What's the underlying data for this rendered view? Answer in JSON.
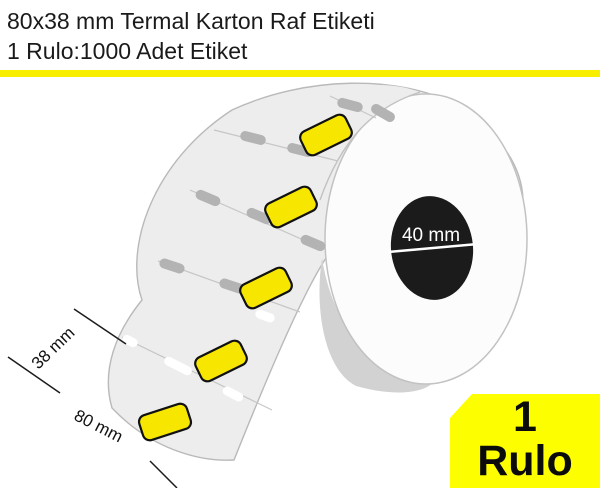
{
  "header": {
    "title_line1": "80x38 mm Termal Karton Raf Etiketi",
    "title_line2": "1 Rulo:1000 Adet Etiket",
    "divider_color": "#f8ee00"
  },
  "illustration": {
    "core_diameter_label": "40 mm",
    "strip_width_label": "38 mm",
    "label_length_label": "80 mm",
    "visible_label_count": 5,
    "colors": {
      "label_fill": "#f7e600",
      "strip_fill": "#ededed",
      "strip_edge": "#b9b9b9",
      "mark_fill": "#b3b3b3",
      "gap_mark_fill": "#ffffff",
      "roll_face": "#fcfcfc",
      "roll_face_edge": "#c2c2c2",
      "core_fill": "#1b1b1b",
      "shadow_fill": "#d2d2d2"
    }
  },
  "badge": {
    "count": "1",
    "unit": "Rulo",
    "bg_color": "#fdff00"
  }
}
